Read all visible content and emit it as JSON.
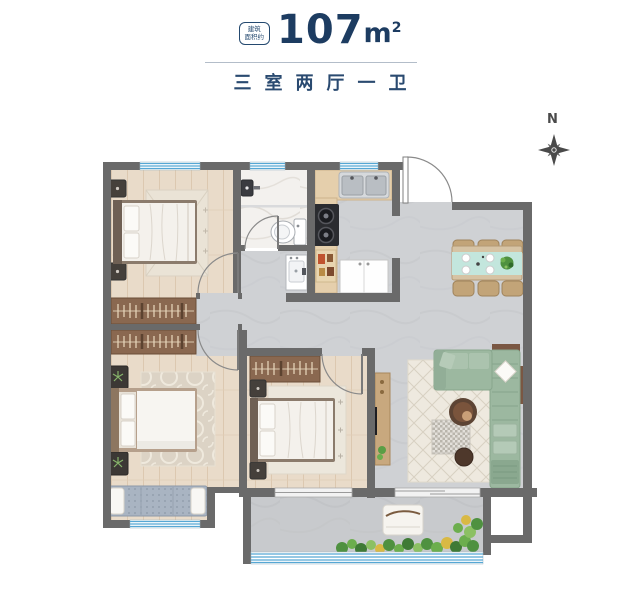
{
  "header": {
    "badge": {
      "line1": "建筑",
      "line2": "面积约"
    },
    "area_number": "107",
    "area_unit": "m",
    "area_superscript": "2",
    "subtitle": "三室两厅一卫"
  },
  "compass": {
    "label": "N"
  },
  "colors": {
    "accent_navy": "#1d3c61",
    "wall_gray": "#6a6a6a",
    "wood_floor": "#e9dbc9",
    "tile_gray": "#cfd1d4",
    "window_blue": "#56a7d4",
    "sofa_green": "#9cb8a0",
    "runner_teal": "#c3e6dd",
    "wardrobe_brown": "#8a6850",
    "plant_green": "#5a9e45"
  }
}
